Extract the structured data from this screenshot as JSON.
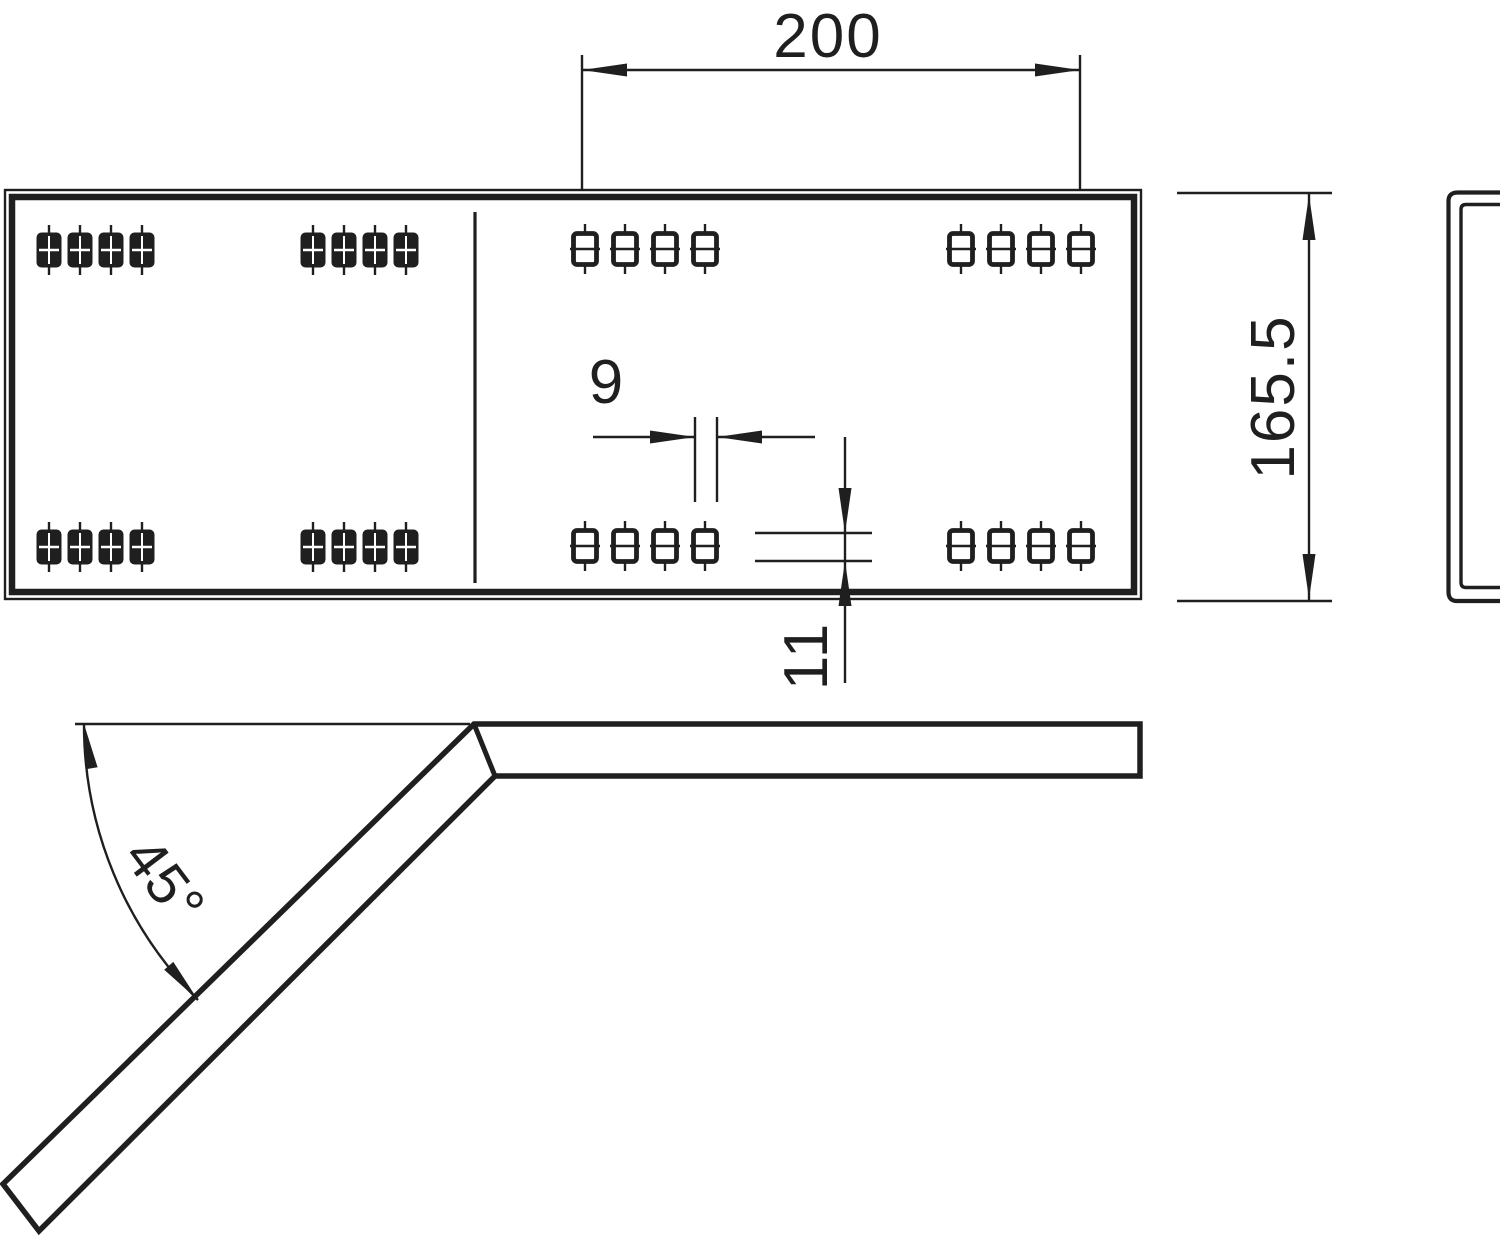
{
  "drawing": {
    "description": "Technical drawing of a 45-degree bend connector plate with slot holes: plan view, bent side view and channel end view",
    "dimensions": {
      "plate_width": "200",
      "plate_height": "165.5",
      "hole_width": "9",
      "hole_height": "11",
      "bend_angle": "45°"
    },
    "hole_pattern": {
      "groups": 8,
      "holes_per_group": 4,
      "filled_style_groups": 4,
      "open_style_groups": 4
    },
    "colors": {
      "line": "#1f1f1f",
      "background": "#ffffff"
    }
  }
}
